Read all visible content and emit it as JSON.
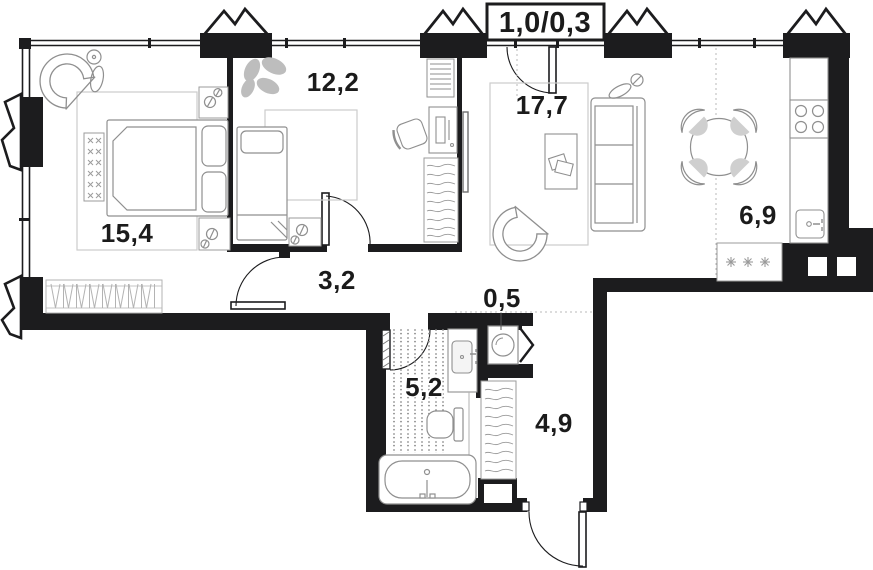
{
  "plan_title": "apartment-floor-plan",
  "balcony": {
    "label": "1,0/0,3"
  },
  "rooms": {
    "bedroom": {
      "name": "bedroom",
      "area": "15,4"
    },
    "kids_room": {
      "name": "kids-room",
      "area": "12,2"
    },
    "living_room": {
      "name": "living-room",
      "area": "17,7"
    },
    "kitchen": {
      "name": "kitchen",
      "area": "6,9"
    },
    "hallway": {
      "name": "hallway",
      "area": "3,2"
    },
    "laundry": {
      "name": "laundry-closet",
      "area": "0,5"
    },
    "bathroom": {
      "name": "bathroom",
      "area": "5,2"
    },
    "entry": {
      "name": "entry-corridor",
      "area": "4,9"
    }
  },
  "colors": {
    "walls": "#1c1c1e",
    "furniture_stroke": "#8f8f8f",
    "light_stroke": "#c7c7c7",
    "shade_fill": "#c3c3c3",
    "label_text": "#1b1b1b"
  }
}
